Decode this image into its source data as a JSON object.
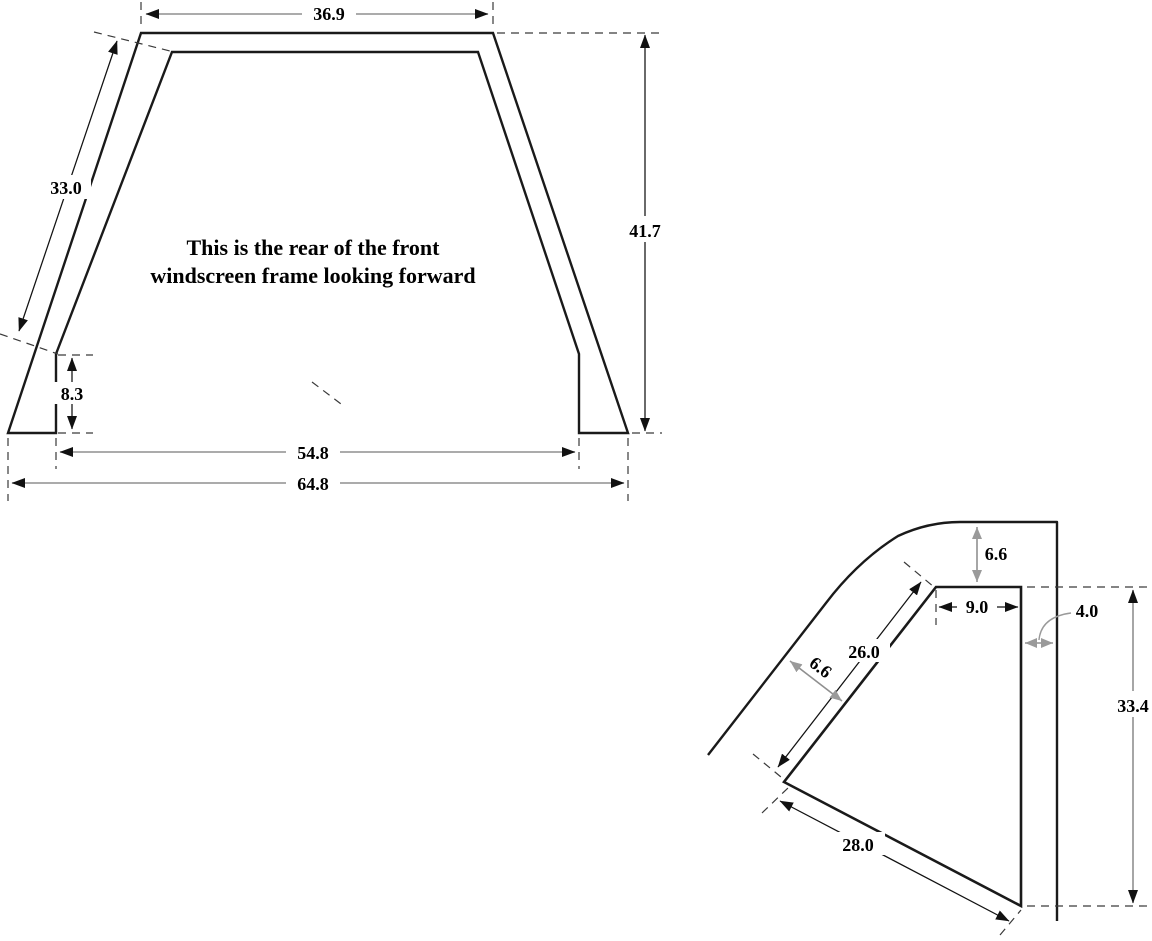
{
  "figure1": {
    "caption": {
      "line1": "This is the rear of the front",
      "line2": "windscreen frame looking forward"
    },
    "dimensions": {
      "top_width": "36.9",
      "pillar_length": "33.0",
      "overall_height": "41.7",
      "foot_height": "8.3",
      "inner_base_width": "54.8",
      "outer_base_width": "64.8"
    }
  },
  "figure2": {
    "dimensions": {
      "top_frame_depth": "6.6",
      "corner_top_width": "9.0",
      "side_gap": "4.0",
      "pillar_inner_length": "26.0",
      "pillar_frame_width": "6.6",
      "side_height": "33.4",
      "lower_edge_length": "28.0"
    }
  },
  "colors": {
    "outline": "#1a1a1a",
    "dimension_gray": "#8f8f8f",
    "extension_dash": "#3a3a3a",
    "text": "#000000",
    "background": "#ffffff"
  }
}
